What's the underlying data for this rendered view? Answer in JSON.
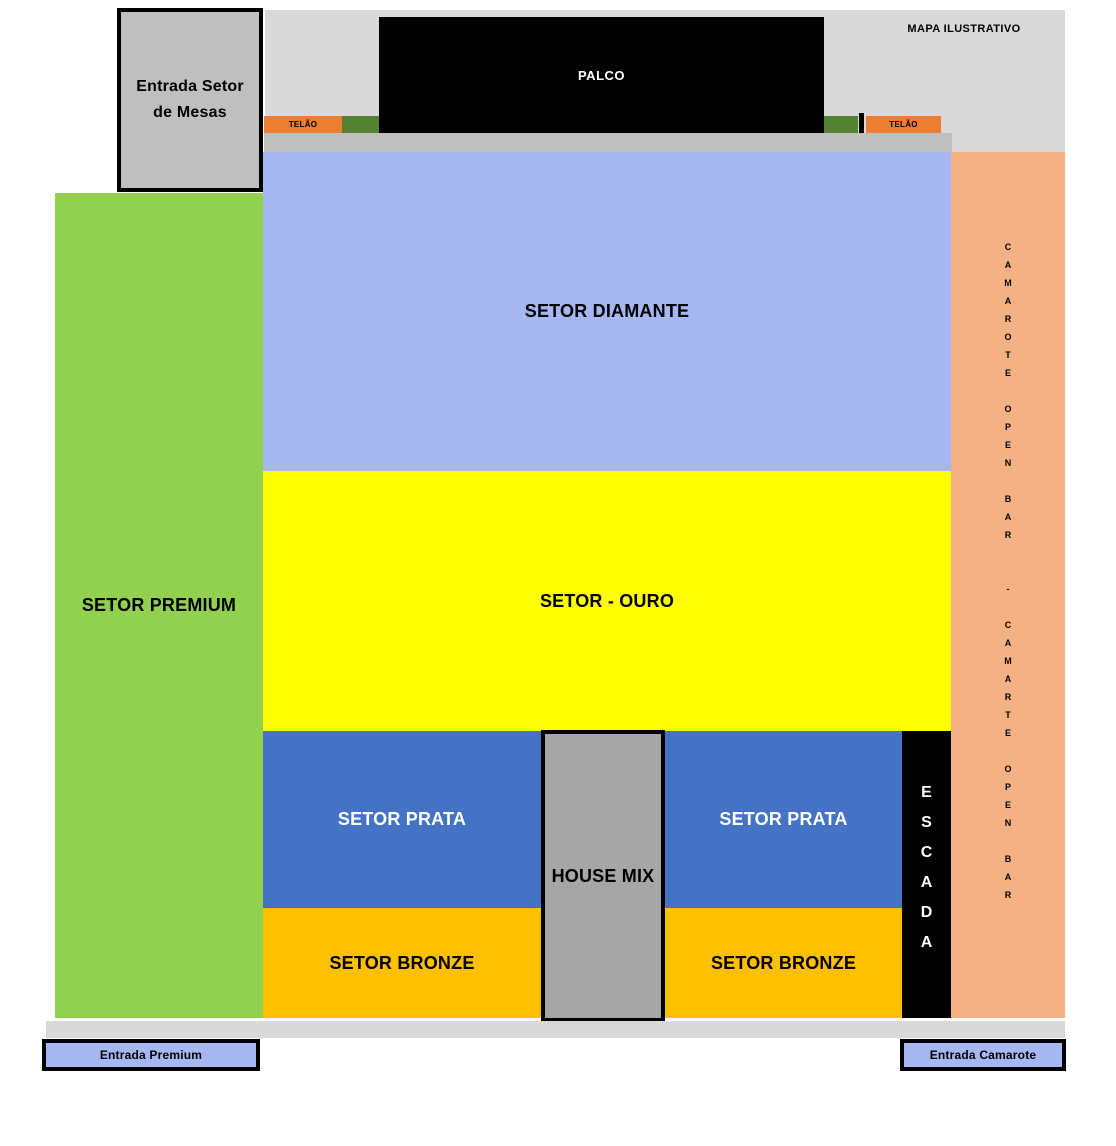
{
  "map": {
    "watermark": "MAPA ILUSTRATIVO",
    "stage": {
      "label": "PALCO"
    },
    "screens": {
      "left_label": "TELÃO",
      "right_label": "TELÃO"
    },
    "sectors": {
      "premium": {
        "label": "SETOR PREMIUM",
        "color": "#92d050"
      },
      "diamante": {
        "label": "SETOR DIAMANTE",
        "color": "#a6b7f2"
      },
      "ouro": {
        "label": "SETOR - OURO",
        "color": "#ffff00"
      },
      "prata_left": {
        "label": "SETOR PRATA",
        "color": "#4472c4"
      },
      "prata_right": {
        "label": "SETOR PRATA",
        "color": "#4472c4"
      },
      "bronze_left": {
        "label": "SETOR BRONZE",
        "color": "#ffc000"
      },
      "bronze_right": {
        "label": "SETOR BRONZE",
        "color": "#ffc000"
      },
      "house_mix": {
        "label": "HOUSE MIX",
        "color": "#a6a6a6"
      }
    },
    "stairs": {
      "label": "ESCADA",
      "letters": [
        "E",
        "S",
        "C",
        "A",
        "D",
        "A"
      ]
    },
    "camarote_strip": {
      "label": "CAMAROTE OPEN BAR - CAMARTE OPEN BAR",
      "color": "#f4b183",
      "letters": [
        "C",
        "A",
        "M",
        "A",
        "R",
        "O",
        "T",
        "E",
        "",
        "O",
        "P",
        "E",
        "N",
        "",
        "B",
        "A",
        "R",
        "",
        "",
        "-",
        "",
        "C",
        "A",
        "M",
        "A",
        "R",
        "T",
        "E",
        "",
        "O",
        "P",
        "E",
        "N",
        "",
        "B",
        "A",
        "R"
      ]
    },
    "entrances": {
      "mesas_line1": "Entrada Setor",
      "mesas_line2": "de Mesas",
      "premium": "Entrada Premium",
      "camarote": "Entrada Camarote"
    },
    "palette": {
      "stage_black": "#000000",
      "screen_orange": "#ed7d31",
      "side_green": "#548235",
      "walkway_gray": "#bfbfbf",
      "background_gray": "#d9d9d9",
      "entrance_blue": "#a6b7f2",
      "entrance_box_gray": "#bfbfbf"
    }
  }
}
